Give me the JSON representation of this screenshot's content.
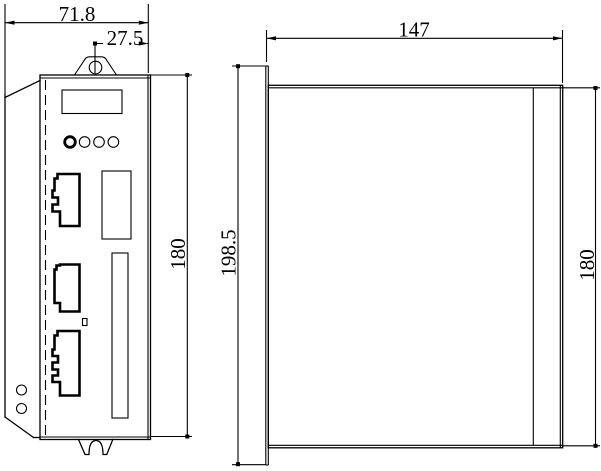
{
  "dimensions": {
    "front_width": "71.8",
    "mount_hole_offset": "27.5",
    "front_height": "180",
    "side_depth": "147",
    "side_overall_height": "198.5",
    "side_body_height": "180"
  },
  "colors": {
    "line": "#000000",
    "background": "#ffffff"
  }
}
